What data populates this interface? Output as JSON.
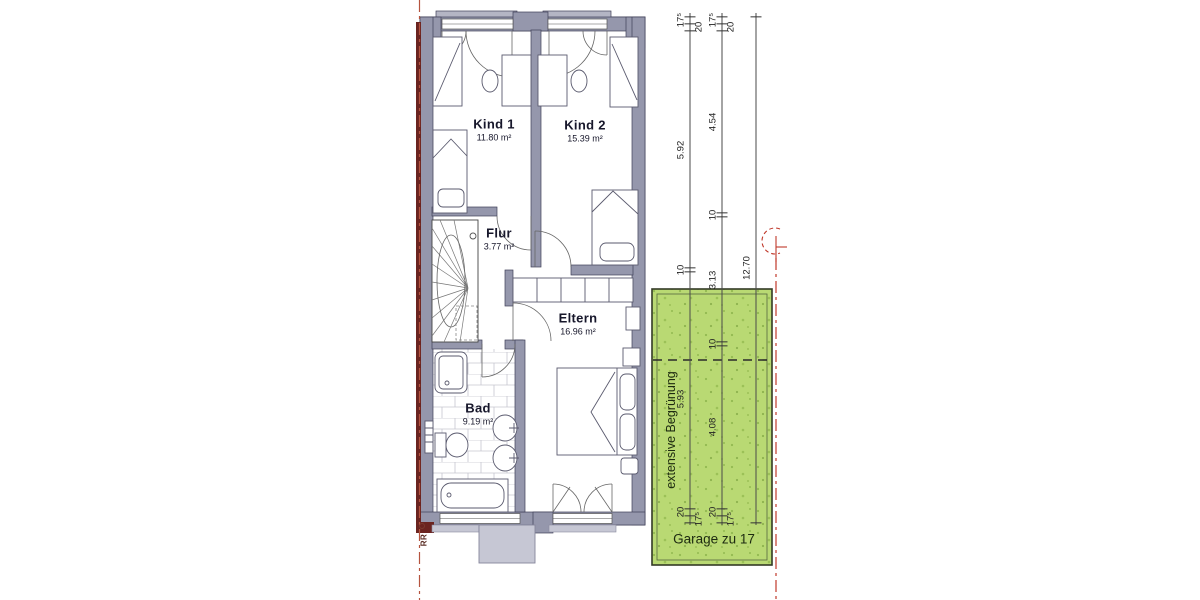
{
  "plan": {
    "rooms": [
      {
        "id": "kind1",
        "name": "Kind 1",
        "area": "11.80 m²",
        "x": 494,
        "y": 130
      },
      {
        "id": "kind2",
        "name": "Kind 2",
        "area": "15.39 m²",
        "x": 585,
        "y": 131
      },
      {
        "id": "flur",
        "name": "Flur",
        "area": "3.77 m²",
        "x": 499,
        "y": 239
      },
      {
        "id": "eltern",
        "name": "Eltern",
        "area": "16.96 m²",
        "x": 578,
        "y": 324
      },
      {
        "id": "bad",
        "name": "Bad",
        "area": "9.19 m²",
        "x": 478,
        "y": 414
      }
    ],
    "green_area": {
      "rotated_label": "extensive Begrünung",
      "garage_label": "Garage zu 17"
    },
    "marker_rr": "RR",
    "colors": {
      "wall": "#9597ac",
      "wall_outline": "#3f3f57",
      "light_gray": "#c6c7d4",
      "green_fill": "#b9d973",
      "green_speckle": "#92b951",
      "red_line": "#c0392b",
      "party_wall_red": "#6b2420",
      "dimension_text": "#222222"
    }
  },
  "dimensions": {
    "chains": [
      {
        "x": 690,
        "ticks": [
          17,
          24,
          31,
          268,
          272,
          509,
          516,
          523
        ],
        "labels": [
          {
            "t": "17⁵",
            "y": 20,
            "side": "l"
          },
          {
            "t": "20",
            "y": 27,
            "side": "r"
          },
          {
            "t": "5.92",
            "y": 150,
            "side": "l"
          },
          {
            "t": "10",
            "y": 270,
            "side": "l"
          },
          {
            "t": "5.93",
            "y": 399,
            "side": "l"
          },
          {
            "t": "20",
            "y": 512,
            "side": "l"
          },
          {
            "t": "17⁵",
            "y": 519,
            "side": "r"
          }
        ]
      },
      {
        "x": 722,
        "ticks": [
          17,
          24,
          31,
          213,
          217,
          342,
          346,
          509,
          516,
          523
        ],
        "labels": [
          {
            "t": "17⁵",
            "y": 20,
            "side": "l"
          },
          {
            "t": "20",
            "y": 27,
            "side": "r"
          },
          {
            "t": "4.54",
            "y": 122,
            "side": "l"
          },
          {
            "t": "10",
            "y": 215,
            "side": "l"
          },
          {
            "t": "3.13",
            "y": 280,
            "side": "l"
          },
          {
            "t": "10",
            "y": 344,
            "side": "l"
          },
          {
            "t": "4.08",
            "y": 427,
            "side": "l"
          },
          {
            "t": "20",
            "y": 512,
            "side": "l"
          },
          {
            "t": "17⁵",
            "y": 519,
            "side": "r"
          }
        ]
      },
      {
        "x": 756,
        "ticks": [
          17,
          523
        ],
        "labels": [
          {
            "t": "12.70",
            "y": 268,
            "side": "l"
          }
        ]
      }
    ]
  }
}
